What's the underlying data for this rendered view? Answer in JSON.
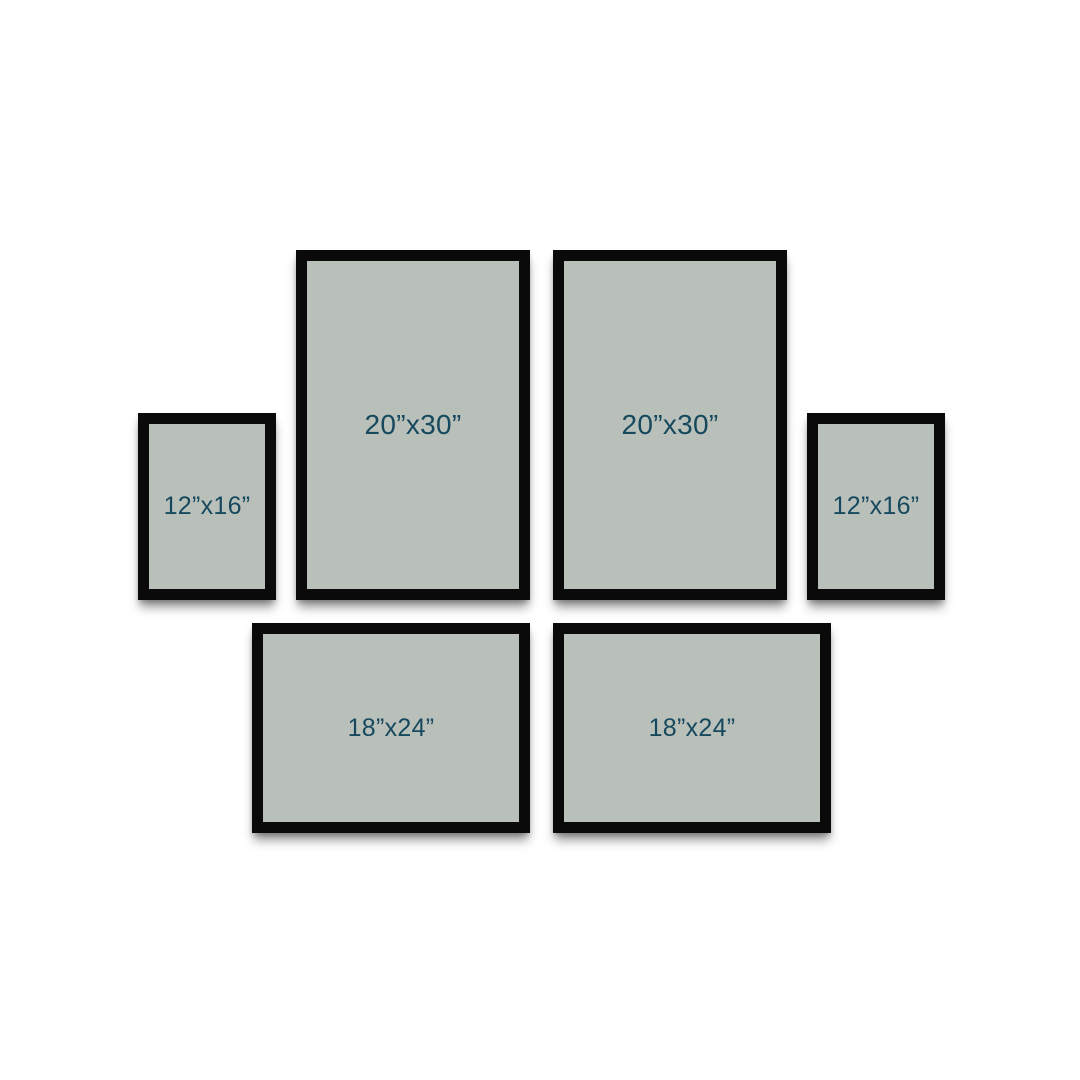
{
  "canvas": {
    "background": "#ffffff"
  },
  "colors": {
    "frame_border": "#0a0a0a",
    "frame_fill": "#b9c0ba",
    "label_text": "#17495e"
  },
  "gallery": {
    "description": "gallery-wall-frame-size-layout",
    "frames": [
      {
        "id": "frame-12x16-left",
        "label": "12”x16”"
      },
      {
        "id": "frame-20x30-left",
        "label": "20”x30”"
      },
      {
        "id": "frame-20x30-right",
        "label": "20”x30”"
      },
      {
        "id": "frame-12x16-right",
        "label": "12”x16”"
      },
      {
        "id": "frame-18x24-left",
        "label": "18”x24”"
      },
      {
        "id": "frame-18x24-right",
        "label": "18”x24”"
      }
    ]
  }
}
